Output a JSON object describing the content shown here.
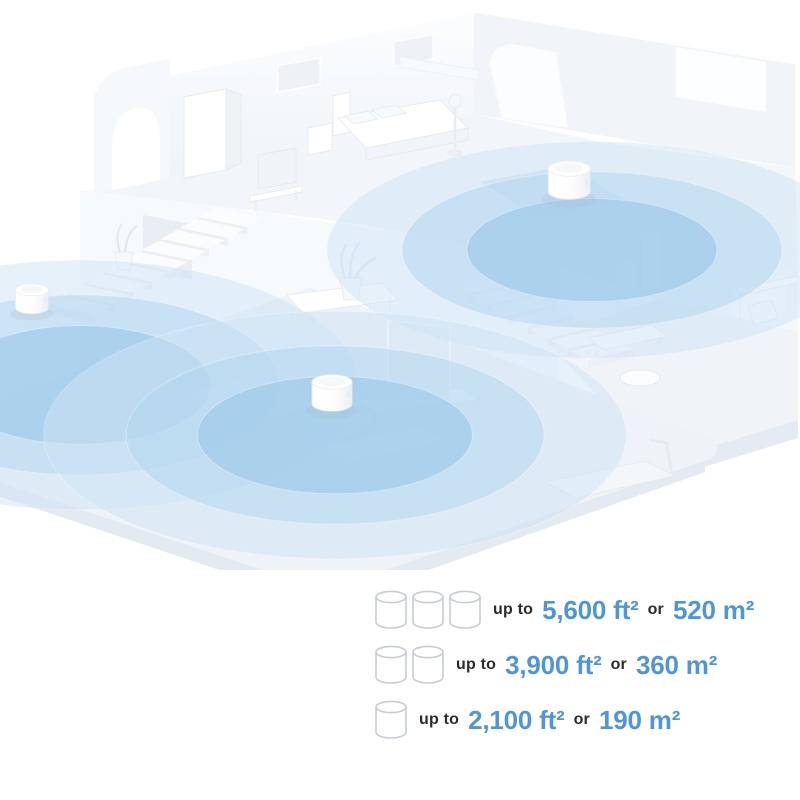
{
  "page": {
    "background": "#ffffff"
  },
  "illustration": {
    "type": "isometric-home-mesh-wifi-coverage",
    "router_count": 3,
    "coverage_colors": {
      "inner": "#9AC8E9",
      "mid": "#B5D8F0",
      "outer": "#CFE4F6"
    }
  },
  "legend": {
    "rows": [
      {
        "units": "3",
        "icon": "mesh-unit-cylinder-icon",
        "prefix": "up to",
        "imperial": "5,600 ft²",
        "conjunction": "or",
        "metric": "520 m²"
      },
      {
        "units": "2",
        "icon": "mesh-unit-cylinder-icon",
        "prefix": "up to",
        "imperial": "3,900 ft²",
        "conjunction": "or",
        "metric": "360 m²"
      },
      {
        "units": "1",
        "icon": "mesh-unit-cylinder-icon",
        "prefix": "up to",
        "imperial": "2,100 ft²",
        "conjunction": "or",
        "metric": "190 m²"
      }
    ]
  },
  "colors": {
    "accent_text_blue": "#4F96D8",
    "text_dark": "#2A2C2E",
    "floor": "#EFF3F7",
    "wall": "#F3F6FA"
  }
}
